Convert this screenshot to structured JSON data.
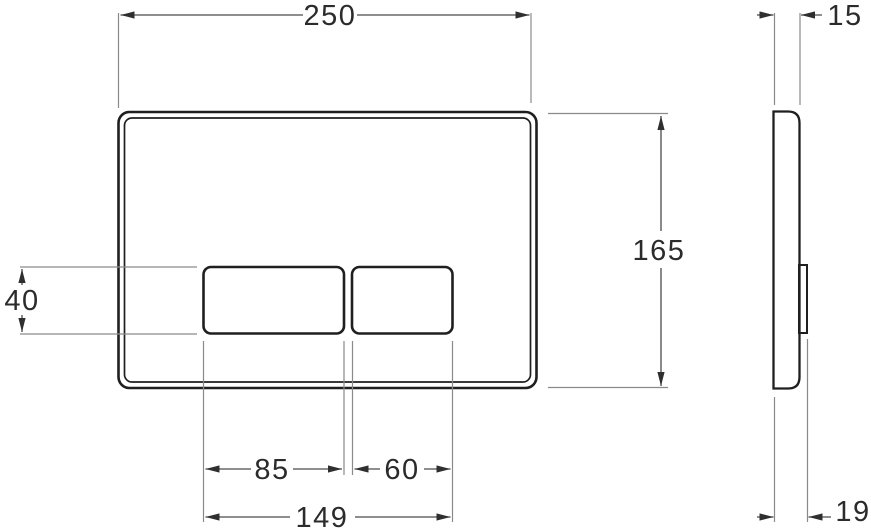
{
  "drawing": {
    "kind": "technical-dimension-drawing",
    "subject": "flush plate with two buttons, front view and side view",
    "units": "mm",
    "front_view": {
      "plate_width": "250",
      "plate_height": "165",
      "button_height": "40",
      "large_button_width": "85",
      "small_button_width": "60",
      "buttons_span_width": "149"
    },
    "side_view": {
      "plate_depth": "15",
      "depth_with_button": "19"
    },
    "colors": {
      "background": "#ffffff",
      "object_line": "#1f1f1f",
      "dimension_line": "#4a4a4a",
      "extension_line": "#8a8a8a",
      "text": "#2b2b2b"
    }
  }
}
